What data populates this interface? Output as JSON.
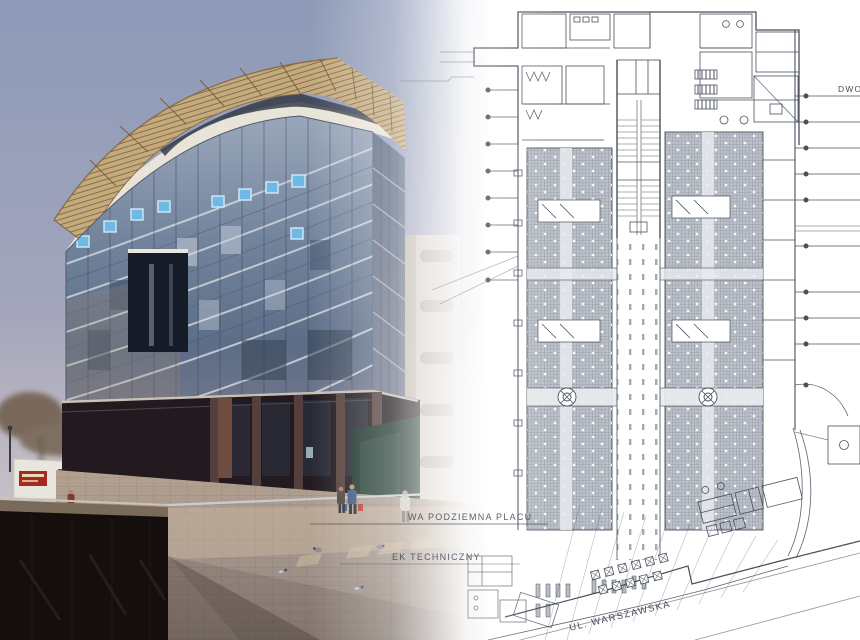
{
  "image": {
    "width": 860,
    "height": 640
  },
  "plan": {
    "labels": {
      "underground_square_fragment": "WA PODZIEMNA PLACU",
      "technical_building_fragment": "EK TECHNICZNY",
      "street_name": "UL. WARSZAWSKA",
      "station_label_clipped": "DWO"
    }
  },
  "colors": {
    "sky_top": "#8d9ab8",
    "sky_horizon": "#c2bcc4",
    "canopy_tan": "#c5aa7e",
    "fascia_white": "#e9e4d8",
    "glass_blue": "#7e90a8",
    "glass_dark": "#4d5f7a",
    "accent_blue": "#6fb9e4",
    "granite_dark": "#221a1e",
    "green_stone": "#1f332c",
    "plaza_tan": "#b3a08f",
    "parapet_black": "#140e0d",
    "sign_red": "#a52b20",
    "plan_line": "#4a505b",
    "plan_text": "#474d58",
    "hatch_gray": "#bcc1c9"
  }
}
